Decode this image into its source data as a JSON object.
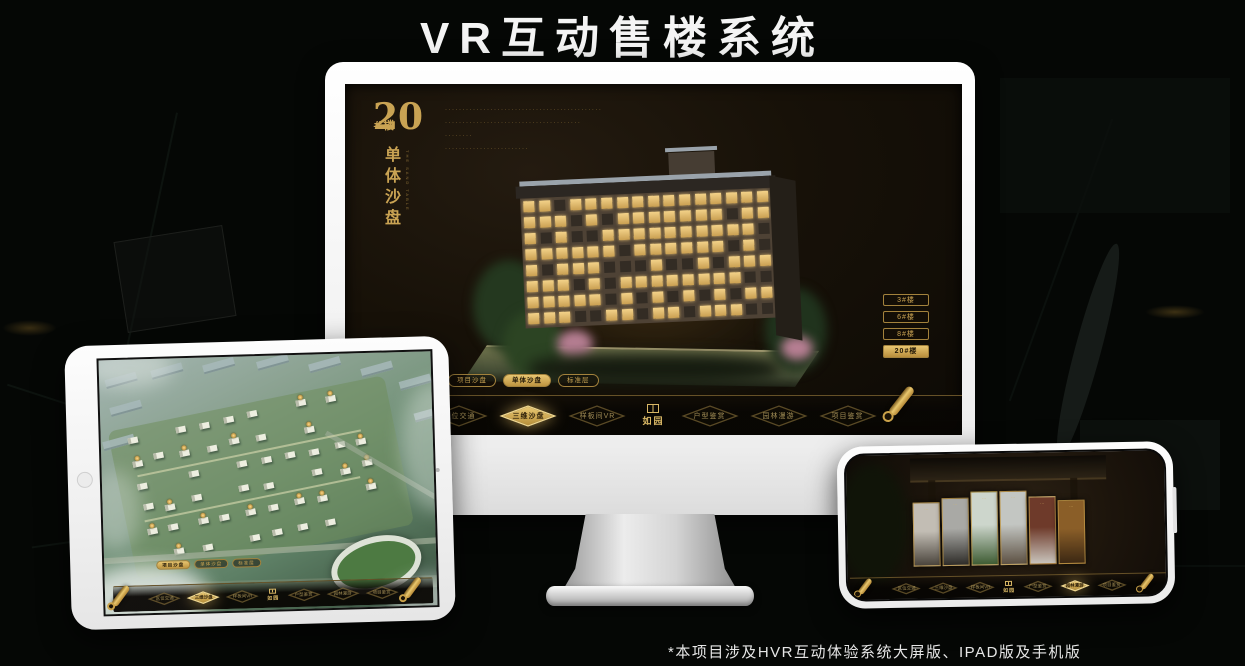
{
  "page": {
    "title": "VR互动售楼系统",
    "footnote": "*本项目涉及HVR互动体验系统大屏版、IPAD版及手机版"
  },
  "colors": {
    "gold": "#c9a353",
    "gold_deep": "#9a7a38",
    "screen_brown": "#17110a"
  },
  "monitor_app": {
    "heading": {
      "number": "20",
      "suffix": "#楼",
      "title_vertical": "单体沙盘",
      "subtitle_en": "THE SAND TABLE"
    },
    "description_lines": [
      "·············································",
      "·······································",
      "········",
      "························"
    ],
    "building_buttons": [
      {
        "label": "3#楼",
        "active": false
      },
      {
        "label": "6#楼",
        "active": false
      },
      {
        "label": "8#楼",
        "active": false
      },
      {
        "label": "20#楼",
        "active": true
      }
    ],
    "sub_tabs": [
      {
        "label": "项目沙盘",
        "active": false
      },
      {
        "label": "单体沙盘",
        "active": true
      },
      {
        "label": "标准层",
        "active": false
      }
    ],
    "nav_left": [
      {
        "label": "区位交通",
        "active": false
      },
      {
        "label": "三维沙盘",
        "active": true
      },
      {
        "label": "样板间VR",
        "active": false
      }
    ],
    "nav_right": [
      {
        "label": "户型鉴赏",
        "active": false
      },
      {
        "label": "园林漫游",
        "active": false
      },
      {
        "label": "项目鉴赏",
        "active": false
      }
    ],
    "logo": "如园"
  },
  "tablet_app": {
    "sub_tabs": [
      {
        "label": "项目沙盘",
        "active": true
      },
      {
        "label": "单体沙盘",
        "active": false
      },
      {
        "label": "标准层",
        "active": false
      }
    ],
    "nav_left": [
      {
        "label": "区位交通",
        "active": false
      },
      {
        "label": "三维沙盘",
        "active": true
      },
      {
        "label": "样板间VR",
        "active": false
      }
    ],
    "nav_right": [
      {
        "label": "户型鉴赏",
        "active": false
      },
      {
        "label": "园林漫游",
        "active": false
      },
      {
        "label": "项目鉴赏",
        "active": false
      }
    ],
    "logo": "如园"
  },
  "phone_app": {
    "nav_left": [
      {
        "label": "区位交通",
        "active": false
      },
      {
        "label": "三维沙盘",
        "active": false
      },
      {
        "label": "样板间VR",
        "active": false
      }
    ],
    "nav_right": [
      {
        "label": "户型鉴赏",
        "active": false
      },
      {
        "label": "园林漫游",
        "active": true
      },
      {
        "label": "项目鉴赏",
        "active": false
      }
    ],
    "logo": "如园",
    "gallery_panels": [
      {
        "name": "interior-scene",
        "top": "#c2bdb4",
        "bottom": "#4a443c"
      },
      {
        "name": "equipment-scene",
        "top": "#a9a9a5",
        "bottom": "#2e2c28"
      },
      {
        "name": "garden-scene",
        "top": "#cdd6cc",
        "bottom": "#3e5c33"
      },
      {
        "name": "building-scene",
        "top": "#c3c6c2",
        "bottom": "#5d5143"
      },
      {
        "name": "courtyard-scene",
        "top": "#6e3a2a",
        "bottom": "#c9c4bc"
      },
      {
        "name": "cabinet-scene",
        "top": "#8a5e28",
        "bottom": "#3c2813"
      }
    ]
  }
}
